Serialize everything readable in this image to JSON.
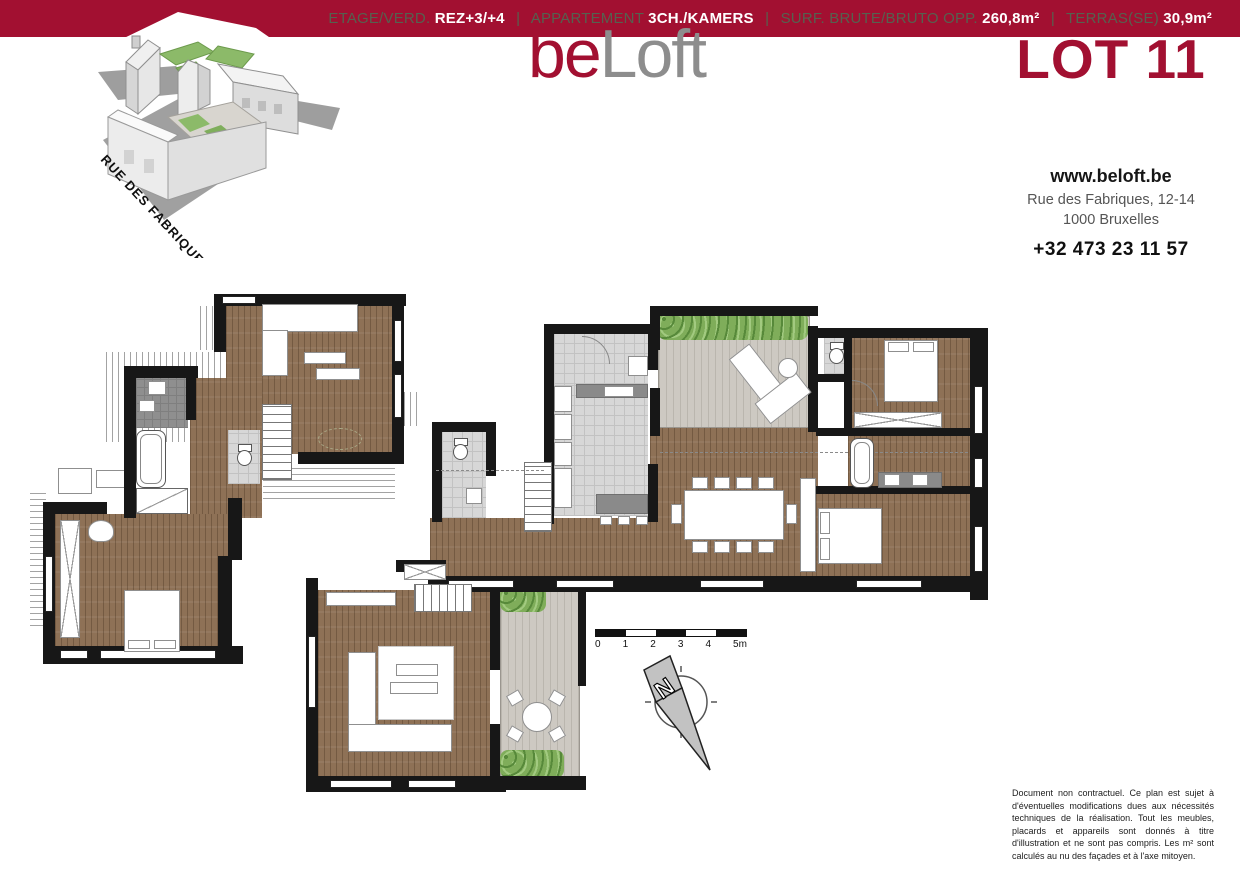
{
  "header": {
    "logo": {
      "part1": "be",
      "part2": "Loft"
    },
    "lot_label": "LOT 11",
    "banner": {
      "separator": "|",
      "items": [
        {
          "label": "ETAGE/VERD.",
          "value": "REZ+3/+4"
        },
        {
          "label": "APPARTEMENT",
          "value": "3CH./KAMERS"
        },
        {
          "label": "SURF. BRUTE/BRUTO OPP.",
          "value": "260,8m²"
        },
        {
          "label": "TERRAS(SE)",
          "value": "30,9m²"
        }
      ]
    },
    "contact": {
      "website": "www.beloft.be",
      "address_line1": "Rue des Fabriques, 12-14",
      "address_line2": "1000 Bruxelles",
      "phone": "+32 473 23 11 57"
    }
  },
  "building": {
    "street_label": "RUE DES FABRIQUES"
  },
  "plan": {
    "scalebar": {
      "labels": [
        "0",
        "1",
        "2",
        "3",
        "4",
        "5m"
      ]
    },
    "compass": {
      "label": "N"
    }
  },
  "disclaimer": "Document non contractuel. Ce plan est sujet à d'éventuelles modifications dues aux nécessités techniques de la réalisation. Tout les meubles, placards et appareils sont donnés à titre d'illustration et ne sont pas compris. Les m² sont calculés au nu des façades et à l'axe mitoyen.",
  "colors": {
    "accent": "#a21031",
    "logo_gray": "#8d8d8d",
    "banner_label": "#56614f",
    "wood": "#8e7156",
    "wall": "#171717",
    "plant_green": "#7fad5a"
  }
}
